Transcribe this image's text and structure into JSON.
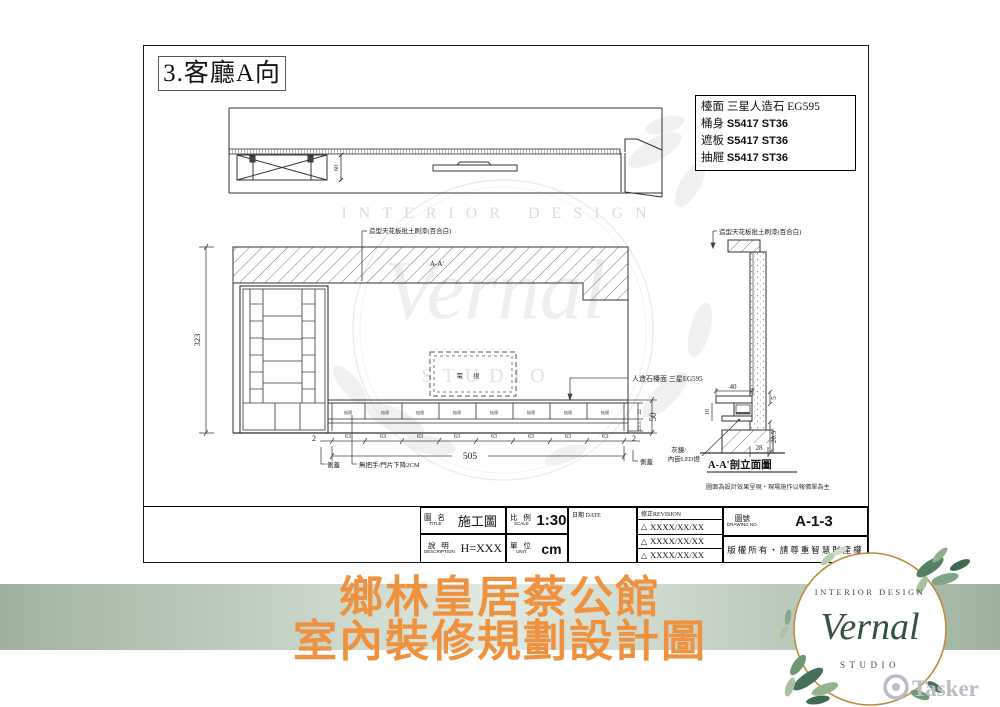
{
  "sheet": {
    "view_title": "3.客廳A向",
    "materials": {
      "rows": [
        {
          "label": "檯面",
          "value": "三星人造石 EG595"
        },
        {
          "label": "桶身",
          "value": "S5417 ST36"
        },
        {
          "label": "遮板",
          "value": "S5417 ST36"
        },
        {
          "label": "抽屜",
          "value": "S5417 ST36"
        }
      ]
    },
    "annotations": {
      "ceiling_note_left": "造型天花板批土刷漆(百合白)",
      "ceiling_note_right": "造型天花板批土刷漆(百合白)",
      "counter_note": "人造石檯面 三星EG595",
      "mirror_note_line1": "灰鏡/",
      "mirror_note_line2": "內嵌LED燈",
      "handle_note": "無把手/門片下降2CM",
      "side_cover_left": "側蓋",
      "side_cover_right": "側蓋",
      "drawer_label": "抽屜",
      "tv_label": "電視",
      "section_label": "A-A'",
      "section_title": "A-A'剖立面圖",
      "disclaimer": "圖面為設計效果呈現‧現場施作以報價單為主"
    },
    "dims": {
      "h_total": "323",
      "d_top": "60",
      "w_total": "505",
      "seg": "63",
      "side": "2",
      "row_top": "22",
      "row_bottom": "23.5",
      "cab_h": "50",
      "c40": "40",
      "c5": "5",
      "c10": "10",
      "c205": "20.5",
      "c28": "28"
    }
  },
  "title_block": {
    "title_label_zh": "圖 名",
    "title_label_en": "TITLE",
    "title_value": "施工圖",
    "scale_label_zh": "比 例",
    "scale_label_en": "SCALE",
    "scale_value": "1:30",
    "date_label": "日期 DATE",
    "desc_label_zh": "說 明",
    "desc_label_en": "DESCRIPTION",
    "desc_value": "H=XXX",
    "unit_label_zh": "單 位",
    "unit_label_en": "UNIT",
    "unit_value": "cm",
    "revision_label": "修正REVISION",
    "revision_mark": "△",
    "revisions": [
      "XXXX/XX/XX",
      "XXXX/XX/XX",
      "XXXX/XX/XX"
    ],
    "drawing_no_label_zh": "圖號",
    "drawing_no_label_en": "DRAWING NO.",
    "drawing_no_value": "A-1-3",
    "copyright": "版權所有‧請尊重智慧財產權"
  },
  "banner": {
    "line1": "鄉林皇居蔡公館",
    "line2": "室內裝修規劃設計圖",
    "text_color": "#ee9240",
    "strip_color": "#a8bba8"
  },
  "logo": {
    "top": "INTERIOR DESIGN",
    "name": "Vernal",
    "bottom": "STUDIO"
  },
  "watermark": {
    "top": "INTERIOR DESIGN",
    "name": "Vernal",
    "bottom": "STUDIO"
  },
  "footer_brand": {
    "name": "Tasker"
  }
}
